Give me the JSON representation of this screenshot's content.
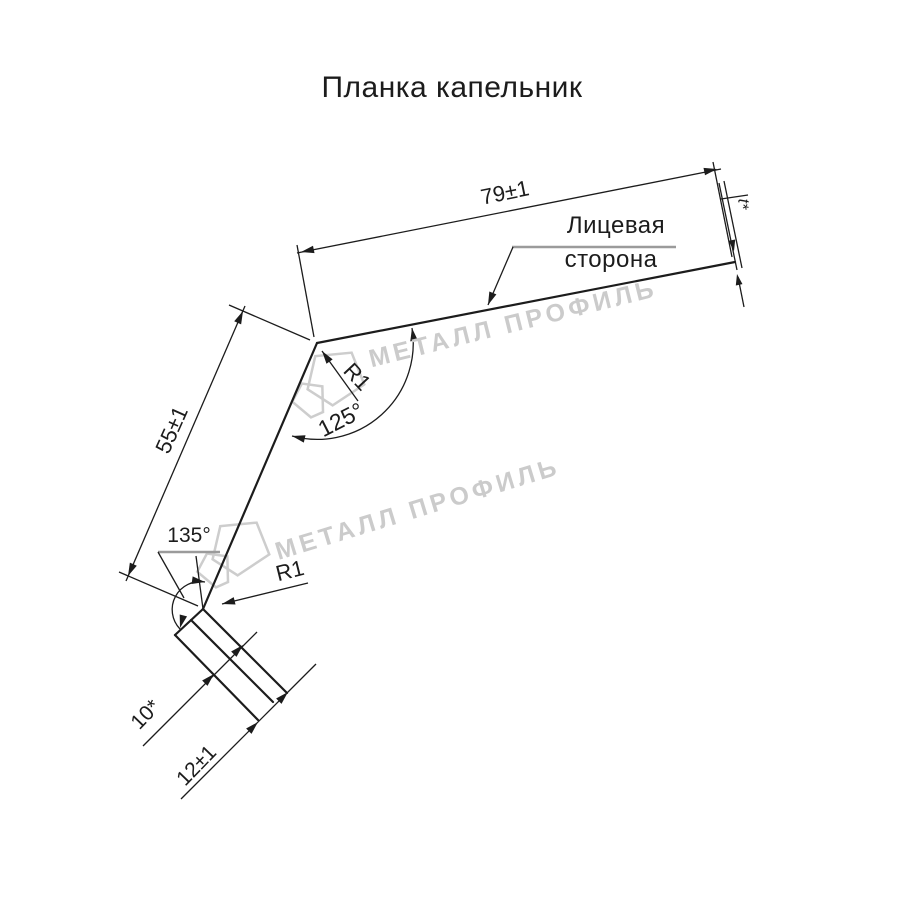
{
  "title": "Планка капельник",
  "colors": {
    "ink": "#1c1c1c",
    "leader_gray": "#9b9b9b",
    "watermark": "#cbcbcb",
    "background": "#ffffff"
  },
  "watermark": {
    "text": "МЕТАЛЛ ПРОФИЛЬ",
    "logo": "metal-profil-pentagon-logo"
  },
  "labels": {
    "dim_top_flange": "79±1",
    "dim_leg": "55±1",
    "angle_top_bend": "125°",
    "angle_bottom_bend": "135°",
    "radius_top": "R1",
    "radius_bottom": "R1",
    "dim_hem": "10*",
    "dim_lip": "12±1",
    "thickness": "t*",
    "face_side_line1": "Лицевая",
    "face_side_line2": "сторона"
  },
  "drawing_data": {
    "type": "technical-cross-section",
    "part_name": "Планка капельник",
    "dimensions": [
      {
        "value": "79±1",
        "feature": "top flange length, mm"
      },
      {
        "value": "55±1",
        "feature": "middle leg length, mm"
      },
      {
        "value": "125°",
        "feature": "upper bend angle"
      },
      {
        "value": "135°",
        "feature": "lower bend angle"
      },
      {
        "value": "R1",
        "feature": "upper bend radius"
      },
      {
        "value": "R1",
        "feature": "lower bend radius"
      },
      {
        "value": "10*",
        "feature": "bottom hem width, mm (reference)"
      },
      {
        "value": "12±1",
        "feature": "bottom lip length, mm"
      },
      {
        "value": "t*",
        "feature": "sheet thickness (reference)"
      }
    ],
    "annotations": [
      "Лицевая сторона"
    ]
  }
}
